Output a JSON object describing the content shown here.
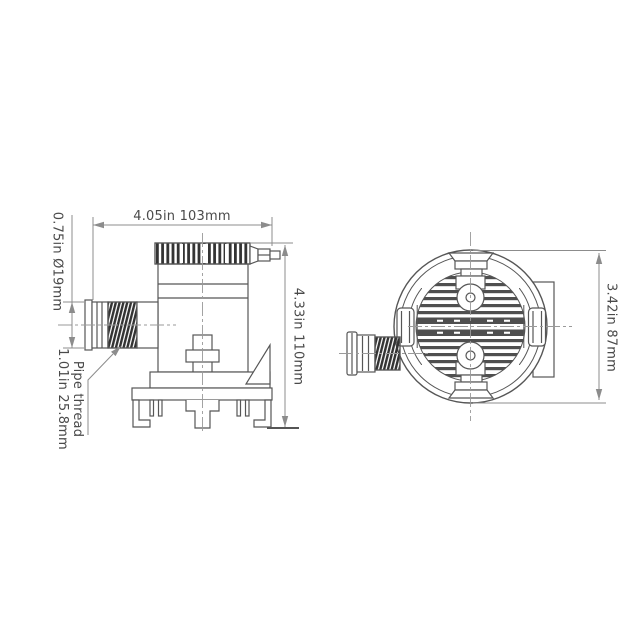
{
  "labels": {
    "top_width": "4.05in 103mm",
    "outlet_diameter": "0.75in Ø19mm",
    "pipe_thread_line1": "Pipe thread",
    "pipe_thread_line2": "1.01in 25.8mm",
    "overall_height": "4.33in 110mm",
    "body_diameter": "3.42in 87mm"
  },
  "colors": {
    "background": "#ffffff",
    "object_line": "#565656",
    "dimension_line": "#8c8c8c",
    "centerline": "#9a9a9a",
    "text": "#4a4a4a",
    "thread_fill": "#333333"
  }
}
